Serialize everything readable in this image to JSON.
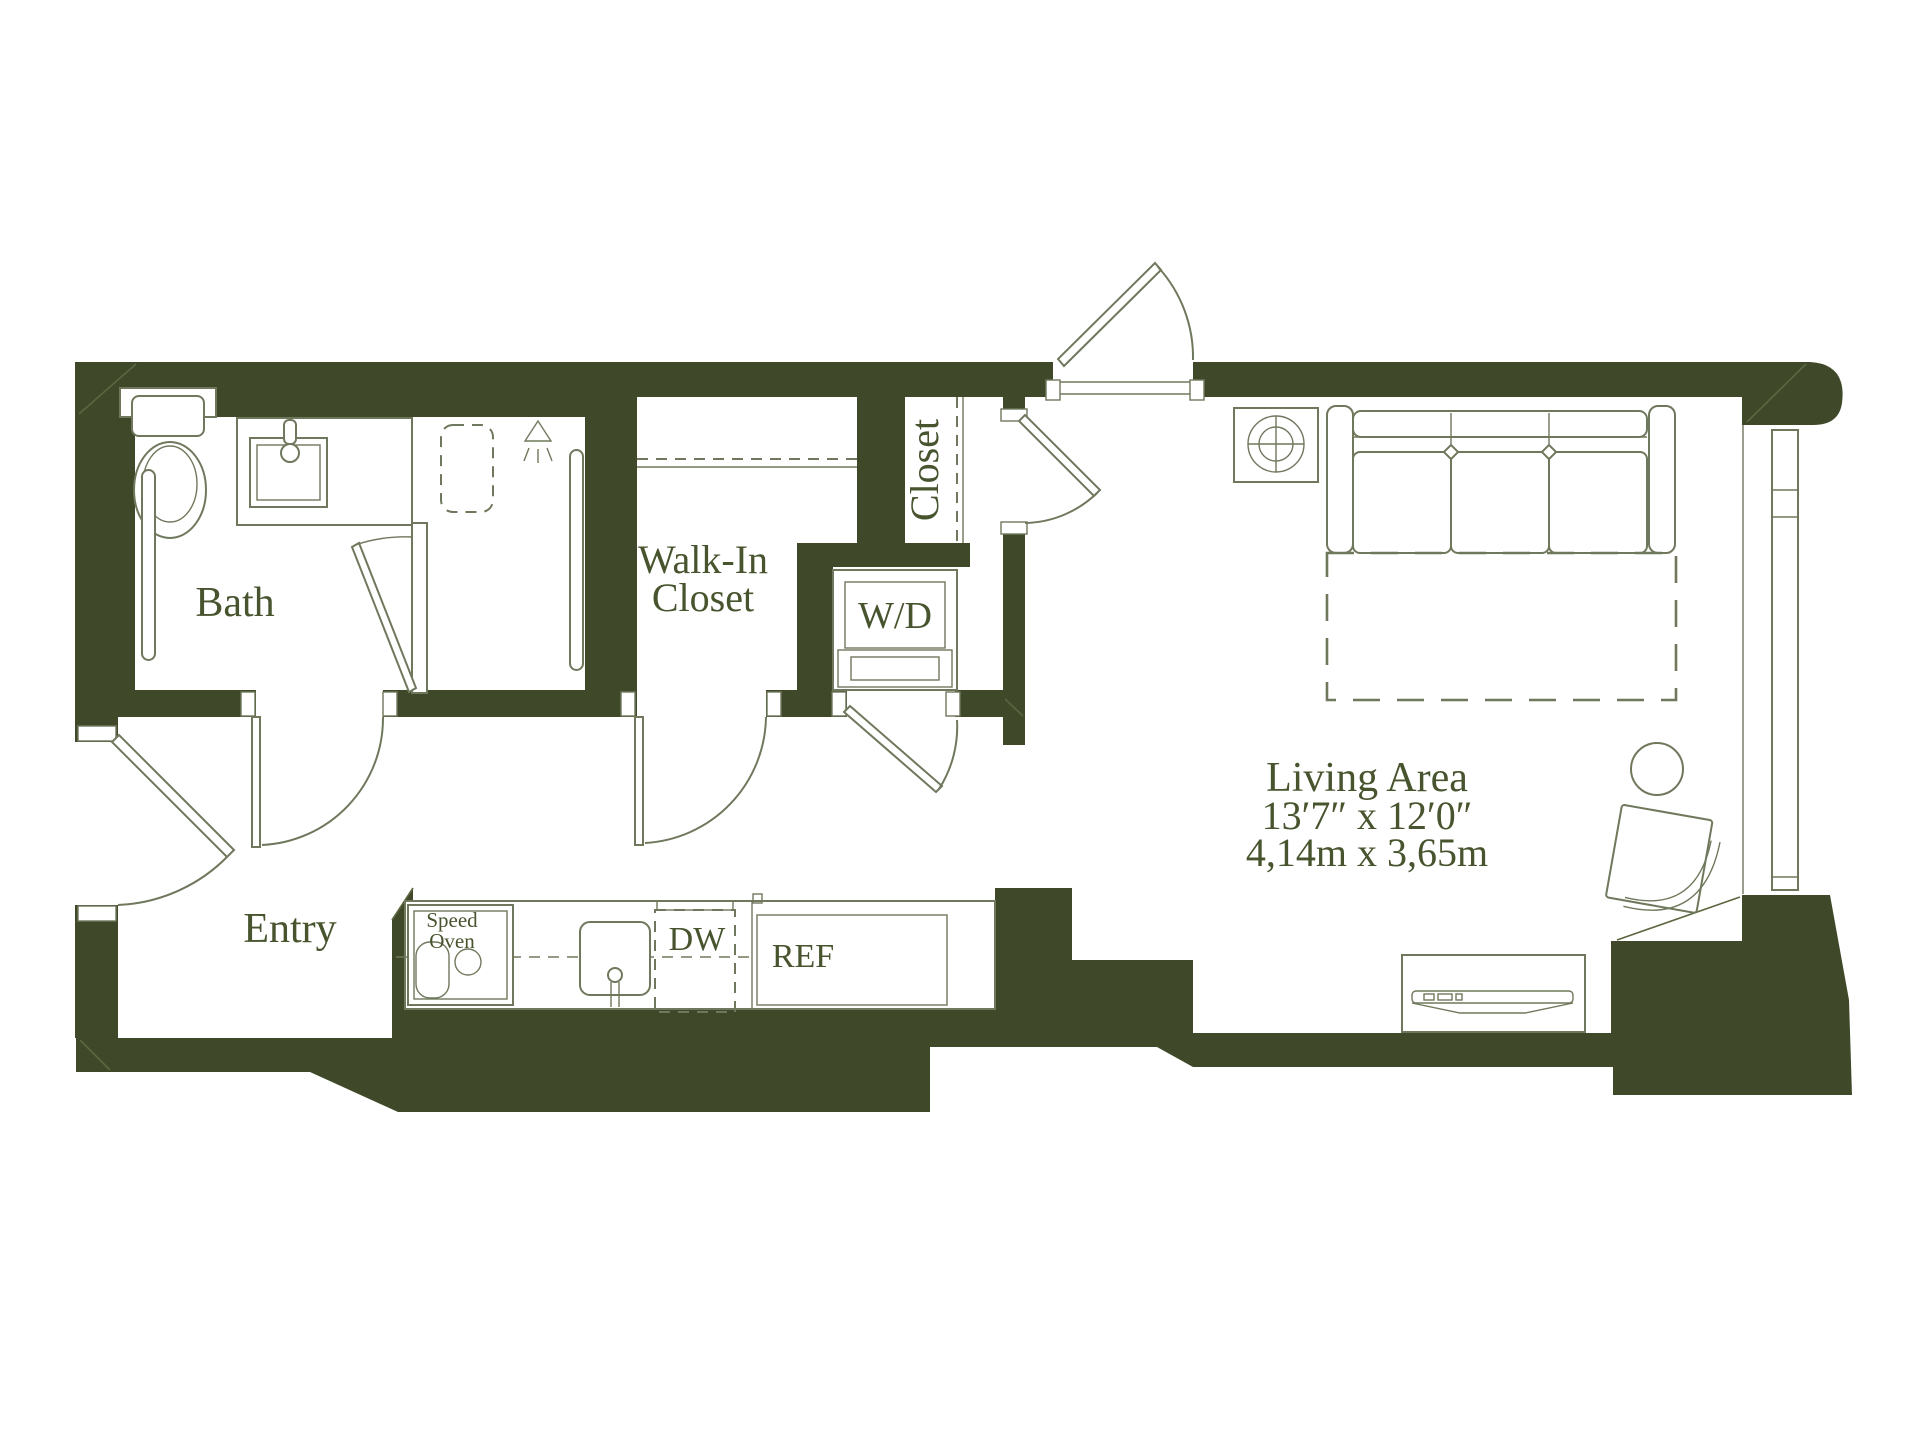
{
  "plan": {
    "type": "apartment-floor-plan",
    "rooms": {
      "bath": {
        "label": "Bath"
      },
      "entry": {
        "label": "Entry"
      },
      "walk_in_closet": {
        "label_line1": "Walk-In",
        "label_line2": "Closet"
      },
      "closet": {
        "label": "Closet"
      },
      "living": {
        "label": "Living Area",
        "dims_imperial": "13′7″ x 12′0″",
        "dims_metric": "4,14m x 3,65m"
      }
    },
    "appliances": {
      "washer_dryer": "W/D",
      "speed_oven_line1": "Speed",
      "speed_oven_line2": "Oven",
      "dishwasher": "DW",
      "refrigerator": "REF"
    },
    "colors": {
      "wall": "#3f4929",
      "line": "#6f785c",
      "miter": "#5c6740",
      "text": "#47542e",
      "background": "#ffffff"
    }
  }
}
